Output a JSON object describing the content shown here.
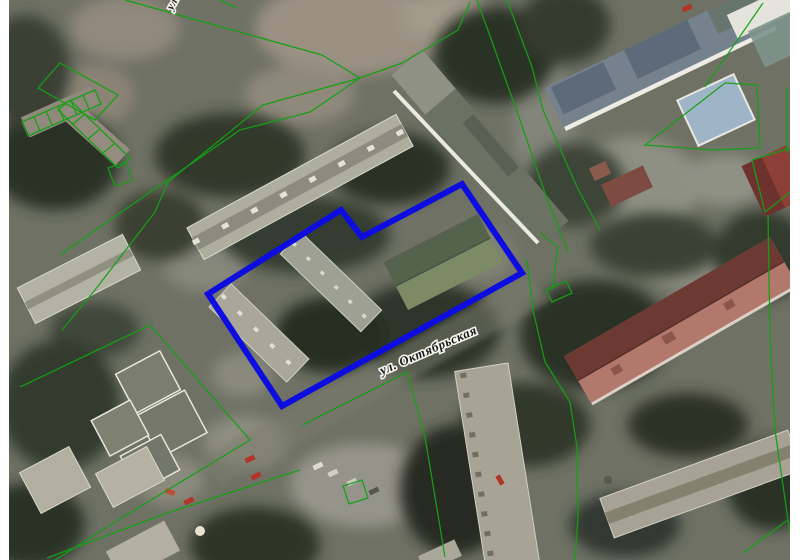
{
  "map": {
    "street_label": "ул. Октябрьская",
    "clipped_street_label_top": "ул.",
    "overlay": {
      "selected_parcel_points": "462,184 522,273 282,406 208,294 341,210 362,237",
      "selected_parcel_color": "#0d0de0",
      "selected_parcel_stroke_width": "6",
      "cadastral_line_color": "#14a014"
    }
  }
}
